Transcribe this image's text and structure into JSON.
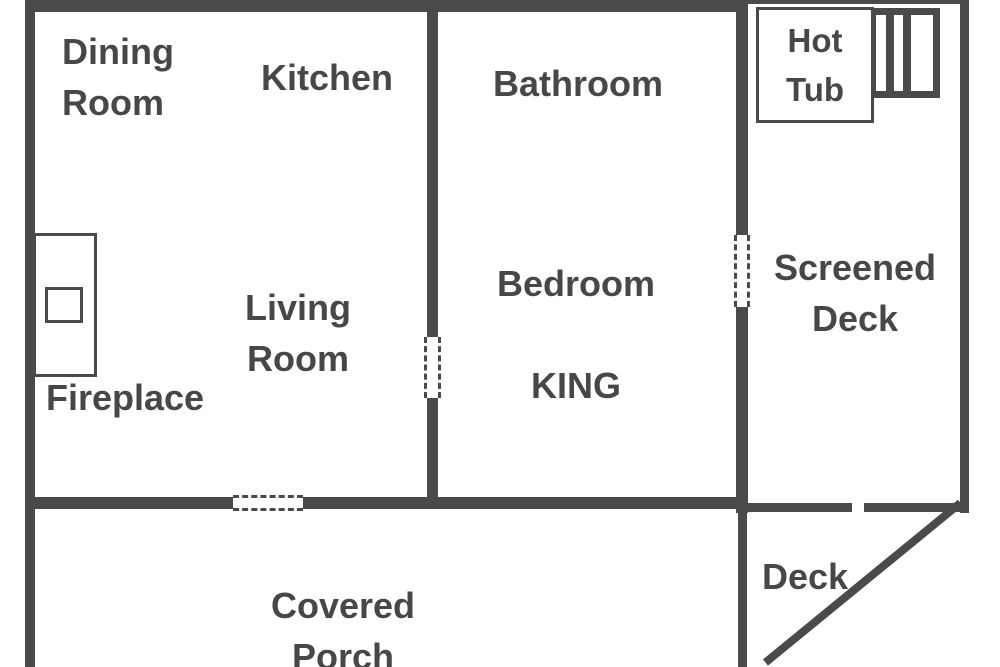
{
  "plan": {
    "title": "Cabin floor plan",
    "colors": {
      "wall": "#4a4a4a",
      "text": "#474747",
      "background": "#ffffff"
    },
    "rooms": {
      "dining_room": "Dining\nRoom",
      "kitchen": "Kitchen",
      "bathroom": "Bathroom",
      "living_room": "Living Room",
      "bedroom": "Bedroom",
      "bed_type": "KING",
      "fireplace": "Fireplace",
      "hot_tub": "Hot\nTub",
      "screened_deck": "Screened\nDeck",
      "covered_porch": "Covered Porch",
      "deck": "Deck"
    }
  }
}
